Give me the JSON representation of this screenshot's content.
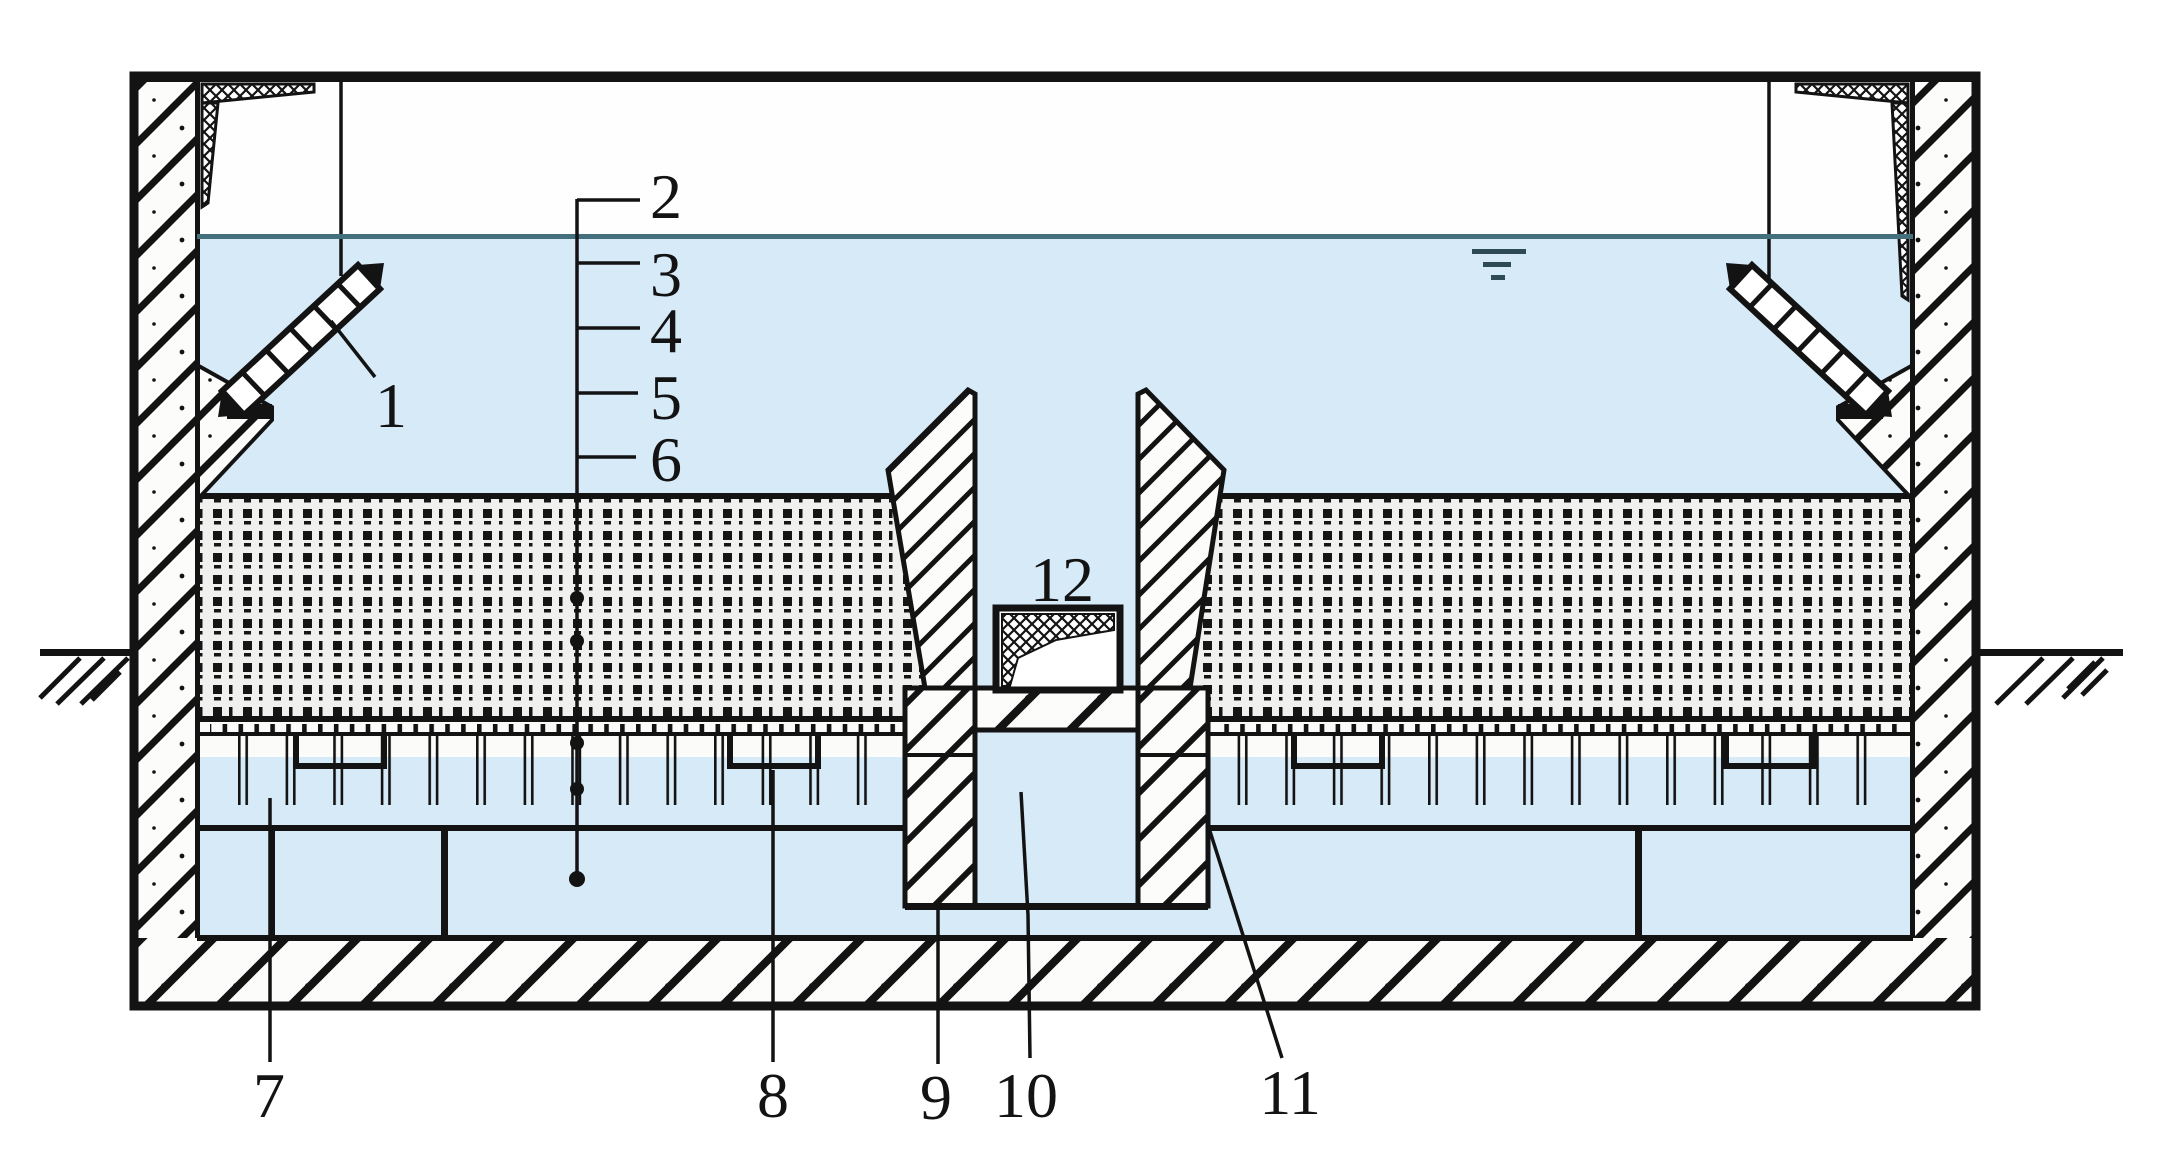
{
  "figure": {
    "type": "patent-cross-section-diagram",
    "callouts": [
      {
        "num": "1"
      },
      {
        "num": "2"
      },
      {
        "num": "3"
      },
      {
        "num": "4"
      },
      {
        "num": "5"
      },
      {
        "num": "6"
      },
      {
        "num": "7"
      },
      {
        "num": "8"
      },
      {
        "num": "9"
      },
      {
        "num": "10"
      },
      {
        "num": "11"
      },
      {
        "num": "12"
      }
    ],
    "colors": {
      "water": "#d7eaf8",
      "water_line": "#44707e",
      "ink": "#131313",
      "stipple_bg": "#f0f0ee",
      "wall_bg": "#fcfcfa"
    }
  }
}
